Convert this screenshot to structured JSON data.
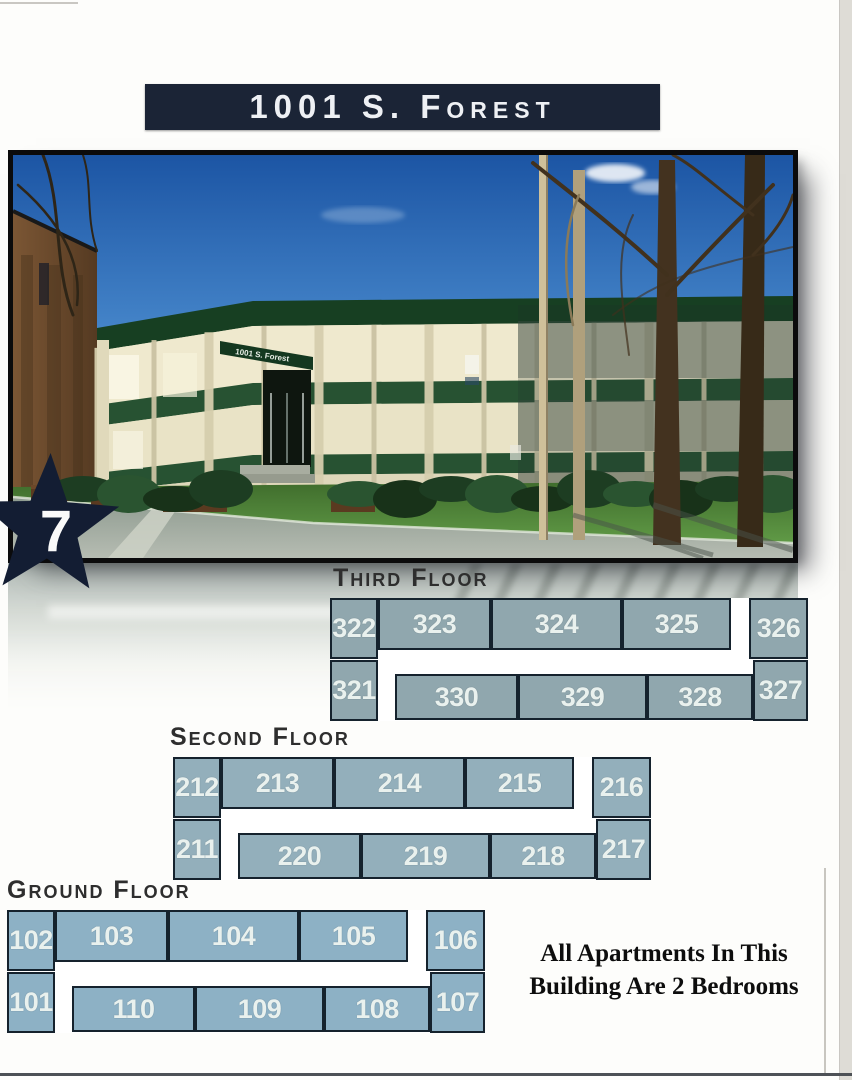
{
  "banner": {
    "text": "1001 S. Forest",
    "bg": "#1b2436"
  },
  "star": {
    "number": "7",
    "color": "#131d33"
  },
  "photo": {
    "awning_sign": "1001 S. Forest"
  },
  "note": {
    "lines": [
      "All Apartments In This",
      "Building Are 2 Bedrooms"
    ]
  },
  "room_slots": {
    "A": {
      "x": 0,
      "y": 0,
      "w": 48,
      "h": 61
    },
    "B": {
      "x": 48,
      "y": 0,
      "w": 113,
      "h": 52
    },
    "C": {
      "x": 161,
      "y": 0,
      "w": 131,
      "h": 52
    },
    "D": {
      "x": 292,
      "y": 0,
      "w": 109,
      "h": 52
    },
    "E": {
      "x": 419,
      "y": 0,
      "w": 59,
      "h": 61
    },
    "F": {
      "x": 0,
      "y": 62,
      "w": 48,
      "h": 61
    },
    "G": {
      "x": 65,
      "y": 76,
      "w": 123,
      "h": 46
    },
    "H": {
      "x": 188,
      "y": 76,
      "w": 129,
      "h": 46
    },
    "I": {
      "x": 317,
      "y": 76,
      "w": 106,
      "h": 46
    },
    "J": {
      "x": 423,
      "y": 62,
      "w": 55,
      "h": 61
    }
  },
  "floors": [
    {
      "id": "third",
      "label": "Third Floor",
      "x": 330,
      "y": 598,
      "label_x": 333,
      "label_y": 564,
      "fill": "#90a7ae",
      "rooms": [
        {
          "slot": "A",
          "number": "322"
        },
        {
          "slot": "B",
          "number": "323"
        },
        {
          "slot": "C",
          "number": "324"
        },
        {
          "slot": "D",
          "number": "325"
        },
        {
          "slot": "E",
          "number": "326"
        },
        {
          "slot": "F",
          "number": "321"
        },
        {
          "slot": "G",
          "number": "330"
        },
        {
          "slot": "H",
          "number": "329"
        },
        {
          "slot": "I",
          "number": "328"
        },
        {
          "slot": "J",
          "number": "327"
        }
      ]
    },
    {
      "id": "second",
      "label": "Second Floor",
      "x": 173,
      "y": 757,
      "label_x": 170,
      "label_y": 723,
      "fill": "#93afbb",
      "rooms": [
        {
          "slot": "A",
          "number": "212"
        },
        {
          "slot": "B",
          "number": "213"
        },
        {
          "slot": "C",
          "number": "214"
        },
        {
          "slot": "D",
          "number": "215"
        },
        {
          "slot": "E",
          "number": "216"
        },
        {
          "slot": "F",
          "number": "211"
        },
        {
          "slot": "G",
          "number": "220"
        },
        {
          "slot": "H",
          "number": "219"
        },
        {
          "slot": "I",
          "number": "218"
        },
        {
          "slot": "J",
          "number": "217"
        }
      ]
    },
    {
      "id": "ground",
      "label": "Ground Floor",
      "x": 7,
      "y": 910,
      "label_x": 7,
      "label_y": 876,
      "fill": "#8db1c5",
      "rooms": [
        {
          "slot": "A",
          "number": "102"
        },
        {
          "slot": "B",
          "number": "103"
        },
        {
          "slot": "C",
          "number": "104"
        },
        {
          "slot": "D",
          "number": "105"
        },
        {
          "slot": "E",
          "number": "106"
        },
        {
          "slot": "F",
          "number": "101"
        },
        {
          "slot": "G",
          "number": "110"
        },
        {
          "slot": "H",
          "number": "109"
        },
        {
          "slot": "I",
          "number": "108"
        },
        {
          "slot": "J",
          "number": "107"
        }
      ]
    }
  ]
}
